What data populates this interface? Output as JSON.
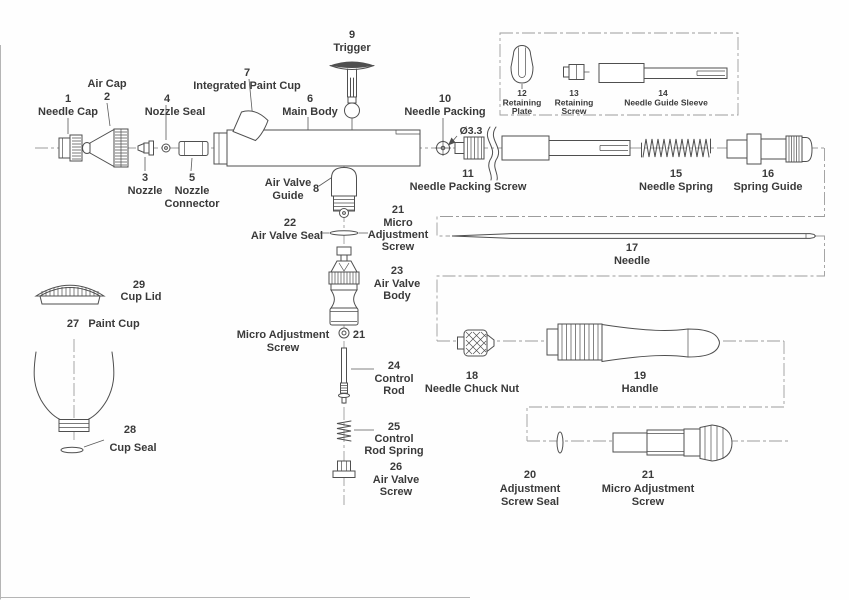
{
  "diagram_title": "Airbrush exploded parts diagram",
  "annotations": {
    "diameter": "Ø3.3"
  },
  "colors": {
    "line": "#4f4f4f",
    "centerline": "#9c9c9c",
    "text": "#3a3a3a",
    "background": "#fefefe"
  },
  "parts": {
    "needle_cap": {
      "num": "1",
      "lines": [
        "Needle Cap"
      ]
    },
    "air_cap": {
      "num": "2",
      "lines": [
        "Air Cap"
      ]
    },
    "nozzle": {
      "num": "3",
      "lines": [
        "Nozzle"
      ]
    },
    "nozzle_seal": {
      "num": "4",
      "lines": [
        "Nozzle Seal"
      ]
    },
    "nozzle_connector": {
      "num": "5",
      "lines": [
        "Nozzle",
        "Connector"
      ]
    },
    "main_body": {
      "num": "6",
      "lines": [
        "Main Body"
      ]
    },
    "integrated_paint_cup": {
      "num": "7",
      "lines": [
        "Integrated Paint Cup"
      ]
    },
    "air_valve_guide": {
      "num": "8",
      "lines": [
        "Air Valve",
        "Guide"
      ]
    },
    "trigger": {
      "num": "9",
      "lines": [
        "Trigger"
      ]
    },
    "needle_packing": {
      "num": "10",
      "lines": [
        "Needle Packing"
      ]
    },
    "needle_packing_screw": {
      "num": "11",
      "lines": [
        "Needle Packing Screw"
      ]
    },
    "retaining_plate": {
      "num": "12",
      "lines": [
        "Retaining",
        "Plate"
      ]
    },
    "retaining_screw": {
      "num": "13",
      "lines": [
        "Retaining",
        "Screw"
      ]
    },
    "needle_guide_sleeve": {
      "num": "14",
      "lines": [
        "Needle Guide Sleeve"
      ]
    },
    "needle_spring": {
      "num": "15",
      "lines": [
        "Needle Spring"
      ]
    },
    "spring_guide": {
      "num": "16",
      "lines": [
        "Spring Guide"
      ]
    },
    "needle": {
      "num": "17",
      "lines": [
        "Needle"
      ]
    },
    "needle_chuck_nut": {
      "num": "18",
      "lines": [
        "Needle Chuck Nut"
      ]
    },
    "handle": {
      "num": "19",
      "lines": [
        "Handle"
      ]
    },
    "adjustment_screw_seal": {
      "num": "20",
      "lines": [
        "Adjustment",
        "Screw Seal"
      ]
    },
    "micro_adjustment_screw": {
      "num": "21",
      "lines": [
        "Micro Adjustment",
        "Screw"
      ]
    },
    "micro_adjustment_screw_stacked": {
      "num": "21",
      "lines": [
        "Micro",
        "Adjustment",
        "Screw"
      ]
    },
    "air_valve_seal": {
      "num": "22",
      "lines": [
        "Air Valve Seal"
      ]
    },
    "air_valve_body": {
      "num": "23",
      "lines": [
        "Air Valve",
        "Body"
      ]
    },
    "control_rod": {
      "num": "24",
      "lines": [
        "Control",
        "Rod"
      ]
    },
    "control_rod_spring": {
      "num": "25",
      "lines": [
        "Control",
        "Rod Spring"
      ]
    },
    "air_valve_screw": {
      "num": "26",
      "lines": [
        "Air Valve",
        "Screw"
      ]
    },
    "paint_cup": {
      "num": "27",
      "lines": [
        "Paint Cup"
      ]
    },
    "cup_seal": {
      "num": "28",
      "lines": [
        "Cup Seal"
      ]
    },
    "cup_lid": {
      "num": "29",
      "lines": [
        "Cup Lid"
      ]
    }
  }
}
